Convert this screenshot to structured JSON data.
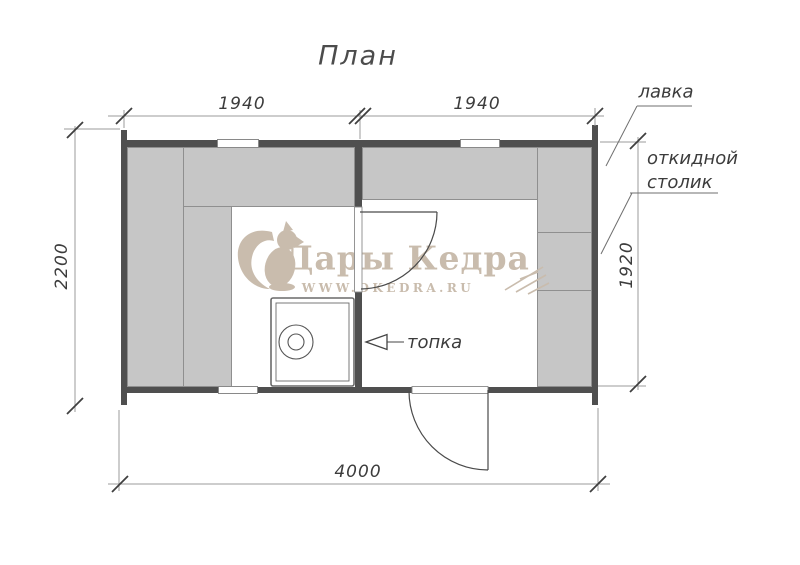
{
  "title": "План",
  "dimensions": {
    "room_left_width": "1940",
    "room_right_width": "1940",
    "height_left": "2200",
    "height_right": "1920",
    "total_width": "4000"
  },
  "labels": {
    "bench": "лавка",
    "folding_table_line1": "откидной",
    "folding_table_line2": "столик",
    "furnace": "топка"
  },
  "watermark": {
    "brand": "Дары Кедра",
    "website": "WWW.DKEDRA.RU"
  },
  "colors": {
    "wall": "#4f4f4f",
    "bench_fill": "#c6c6c6",
    "bench_border": "#8f8f8f",
    "linework": "#4a4a4a",
    "dim_line": "#9b9b9b",
    "text": "#3c3c3c",
    "watermark": "#c9bcad"
  }
}
